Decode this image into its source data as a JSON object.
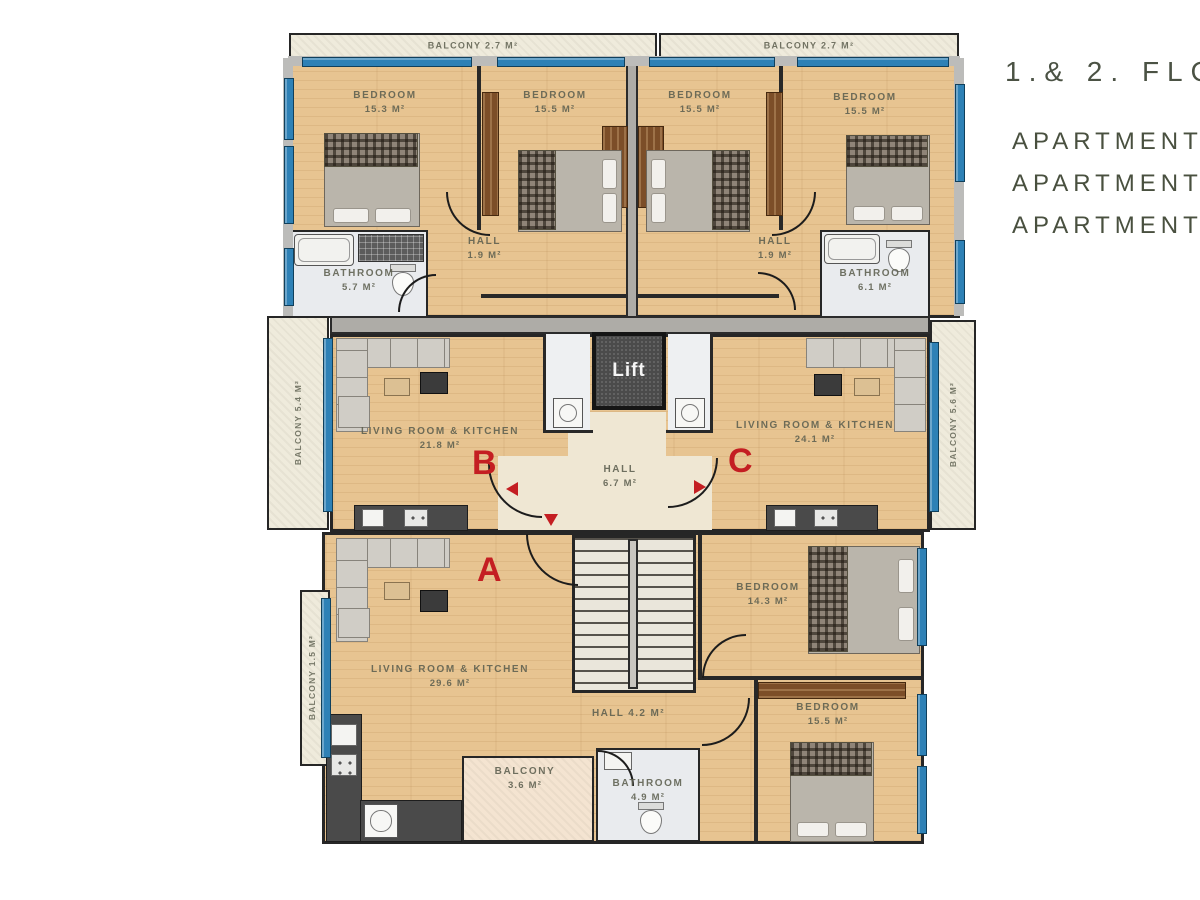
{
  "header": {
    "floor_title": "1.& 2. FLO",
    "apartment_lines": [
      "APARTMENT",
      "APARTMENT",
      "APARTMENT"
    ]
  },
  "plan": {
    "lift": "Lift",
    "letters": {
      "a": "A",
      "b": "B",
      "c": "C"
    },
    "rooms": {
      "balcony_top_left": {
        "label": "BALCONY 2.7 M²"
      },
      "balcony_top_right": {
        "label": "BALCONY 2.7 M²"
      },
      "bedroom_b1": {
        "name": "BEDROOM",
        "area": "15.3 M²"
      },
      "bedroom_b2": {
        "name": "BEDROOM",
        "area": "15.5 M²"
      },
      "bedroom_c1": {
        "name": "BEDROOM",
        "area": "15.5 M²"
      },
      "bedroom_c2": {
        "name": "BEDROOM",
        "area": "15.5 M²"
      },
      "bathroom_b": {
        "name": "BATHROOM",
        "area": "5.7 M²"
      },
      "hall_b": {
        "name": "HALL",
        "area": "1.9 M²"
      },
      "hall_c": {
        "name": "HALL",
        "area": "1.9 M²"
      },
      "bathroom_c": {
        "name": "BATHROOM",
        "area": "6.1 M²"
      },
      "balcony_left": {
        "label": "BALCONY 5.4 M²"
      },
      "balcony_right": {
        "label": "BALCONY 5.6 M²"
      },
      "living_b": {
        "name": "LIVING ROOM & KITCHEN",
        "area": "21.8 M²"
      },
      "living_c": {
        "name": "LIVING ROOM & KITCHEN",
        "area": "24.1 M²"
      },
      "hall_center": {
        "name": "HALL",
        "area": "6.7 M²"
      },
      "living_a": {
        "name": "LIVING ROOM & KITCHEN",
        "area": "29.6 M²"
      },
      "bedroom_a1": {
        "name": "BEDROOM",
        "area": "14.3 M²"
      },
      "hall_a": {
        "label": "HALL 4.2 M²"
      },
      "bedroom_a2": {
        "name": "BEDROOM",
        "area": "15.5 M²"
      },
      "bathroom_a": {
        "name": "BATHROOM",
        "area": "4.9 M²"
      },
      "balcony_a": {
        "name": "BALCONY",
        "area": "3.6 M²"
      },
      "balcony_a_left": {
        "label": "BALCONY 1.5 M²"
      }
    }
  },
  "colors": {
    "window_blue": "#2e81b6",
    "wall_dark": "#282828",
    "accent_red": "#c41e22",
    "wood_floor": "#e7c491"
  }
}
